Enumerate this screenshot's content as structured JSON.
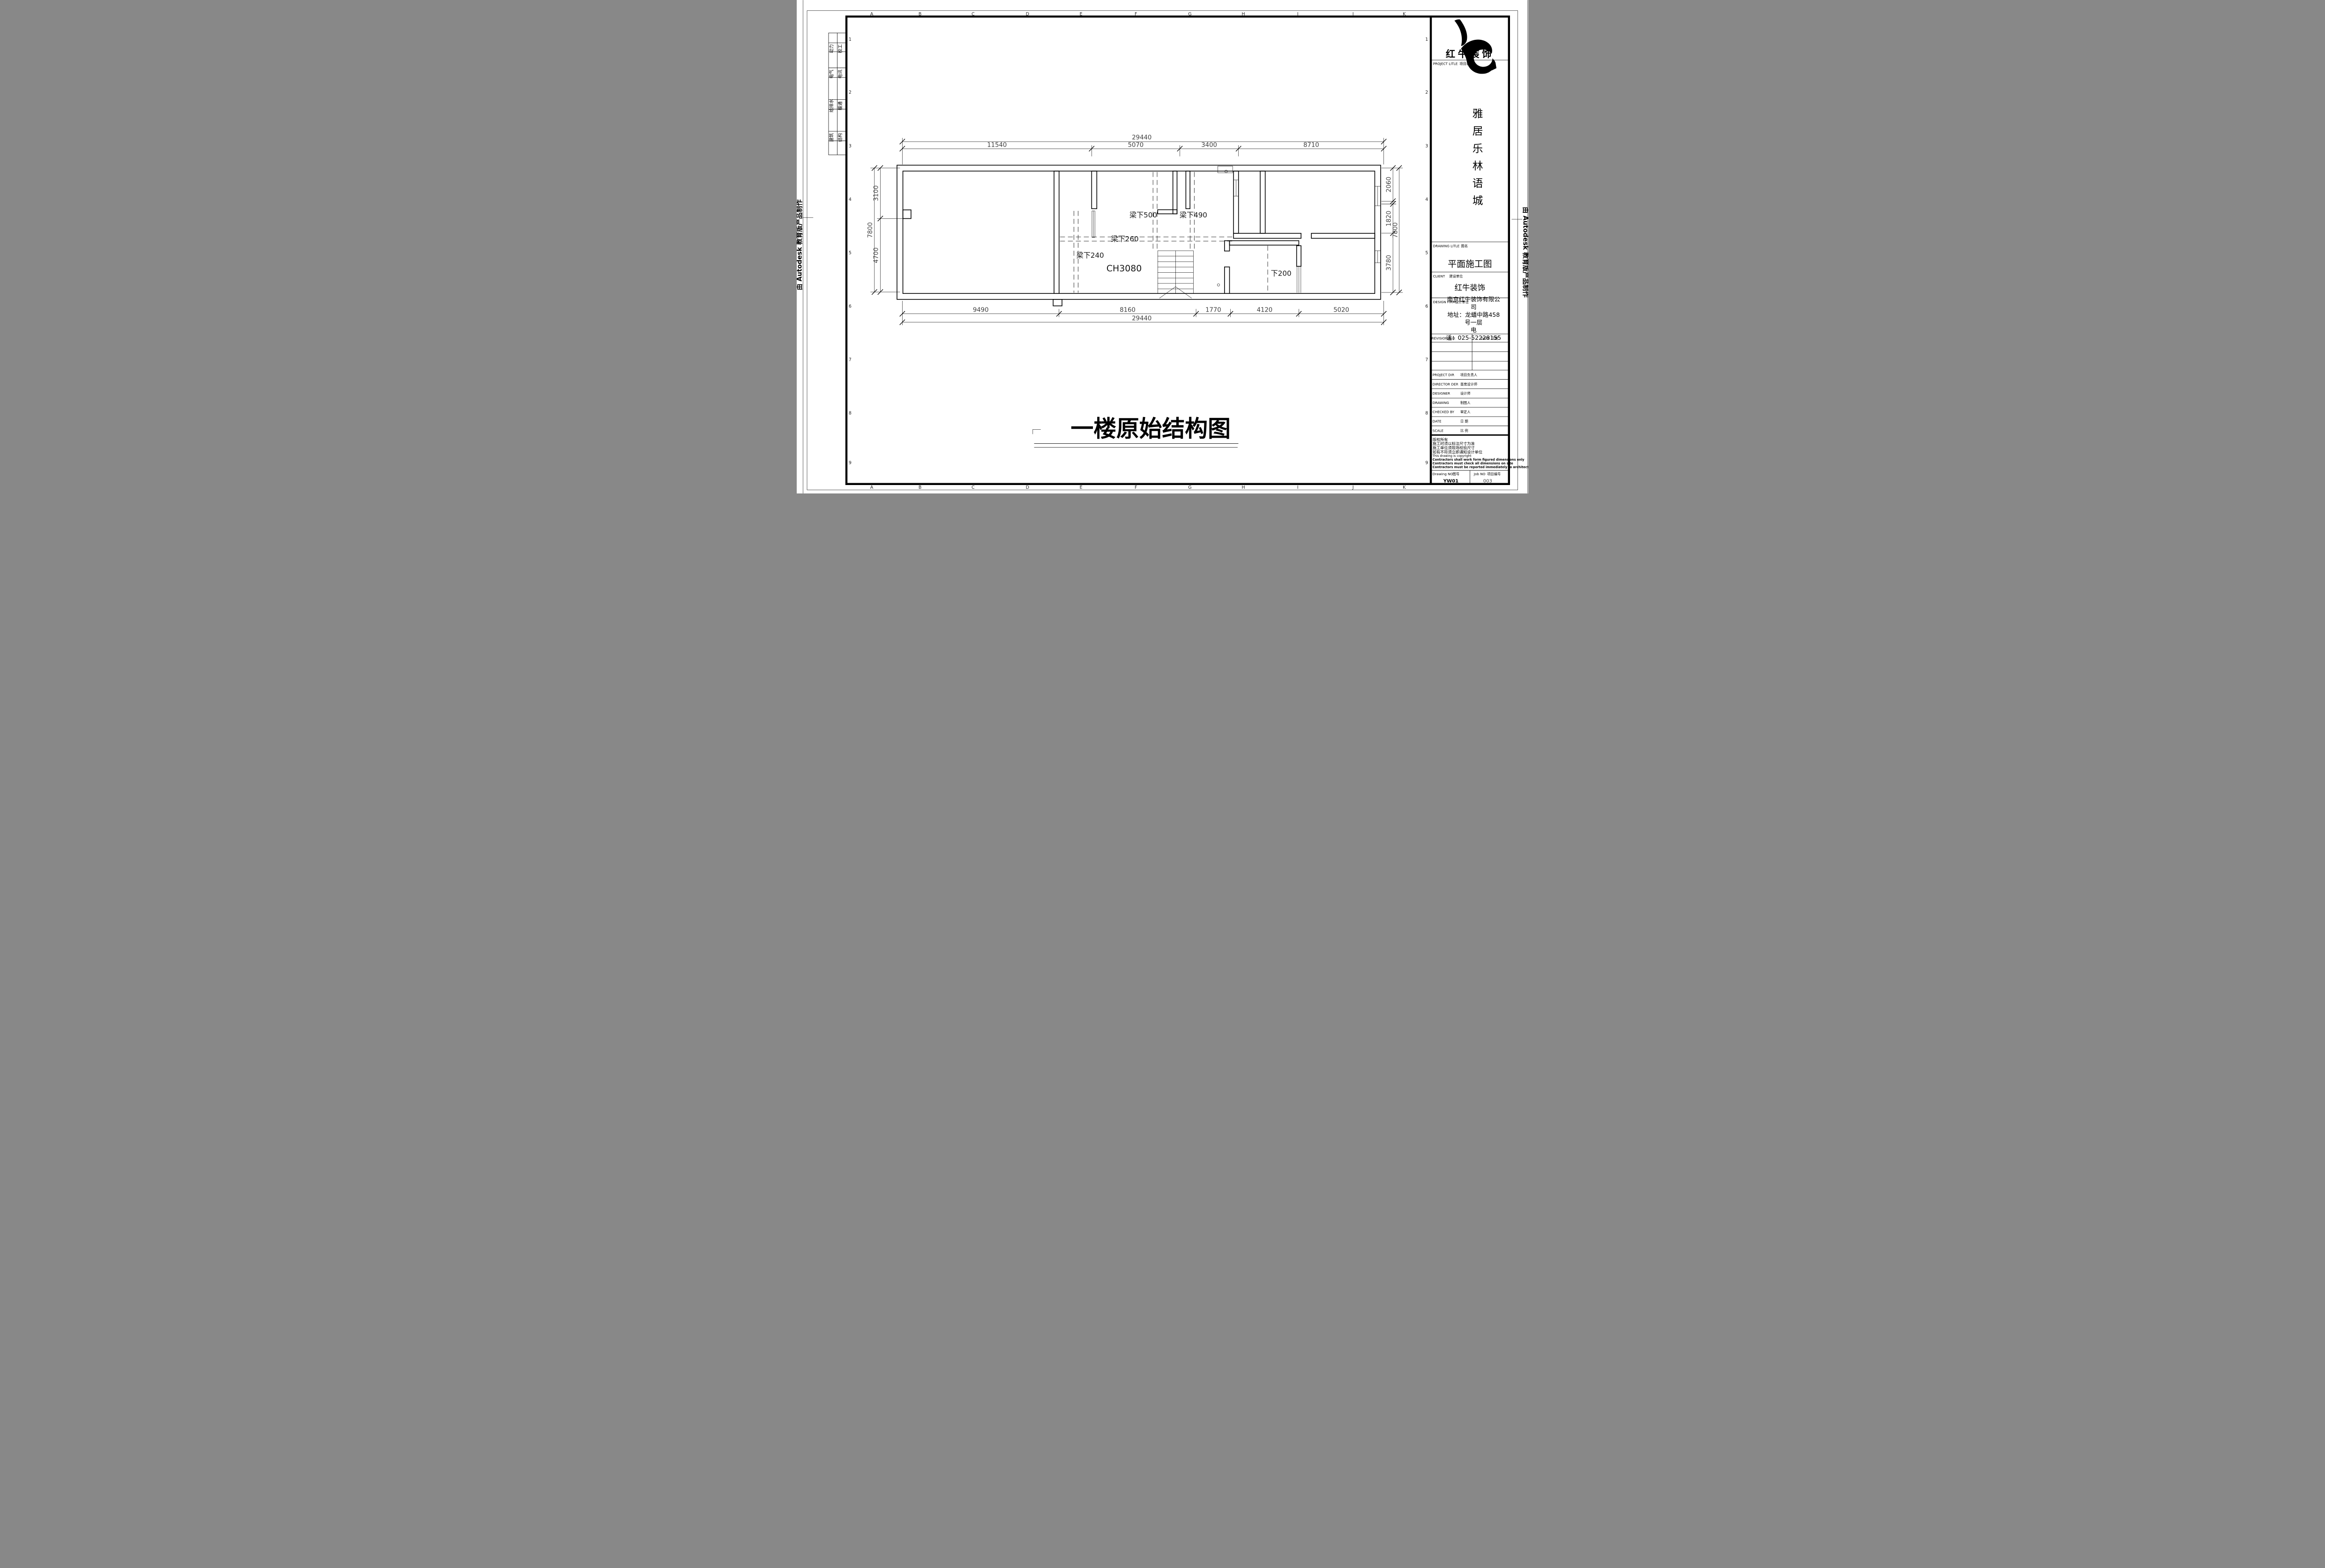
{
  "edges": {
    "autodesk_left": "由 Autodesk 教育版产品制作",
    "autodesk_right": "由 Autodesk 教育版产品制作"
  },
  "grid": {
    "letters": [
      "A",
      "B",
      "C",
      "D",
      "E",
      "F",
      "G",
      "H",
      "I",
      "J",
      "K"
    ],
    "numbers": [
      "1",
      "2",
      "3",
      "4",
      "5",
      "6",
      "7",
      "8",
      "9"
    ]
  },
  "disciplines": {
    "col1": [
      "动力",
      "电气",
      "给排水",
      "建筑"
    ],
    "col2": [
      "校工",
      "电讯",
      "暖通",
      "结构"
    ]
  },
  "plan": {
    "labels": {
      "beam500": "梁下500",
      "beam490": "梁下490",
      "beam260": "梁下260",
      "beam240": "梁下240",
      "ceiling_height": "CH3080",
      "down200": "下200"
    },
    "dims": {
      "top_overall": "29440",
      "top_chain": [
        "11540",
        "5070",
        "3400",
        "8710"
      ],
      "bottom_chain": [
        "9490",
        "8160",
        "1770",
        "4120",
        "5020"
      ],
      "bottom_overall": "29440",
      "left_outer": "7800",
      "left_chain": [
        "3100",
        "4700"
      ],
      "right_chain": [
        "2060",
        "1820",
        "3780"
      ],
      "right_outer": "7800"
    }
  },
  "title": {
    "text": "一楼原始结构图"
  },
  "title_block": {
    "logo_text": "红牛装饰",
    "project_label_en": "PROJECT LITLE",
    "project_label_cn": "项目名称",
    "project_name_chars": [
      "雅",
      "居",
      "乐",
      "林",
      "语",
      "城"
    ],
    "drawing_label_en": "DRAWING LITLE",
    "drawing_label_cn": "图名",
    "drawing_title": "平面施工图",
    "client_label_en": "CLIENT",
    "client_label_cn": "建设单位",
    "client_name": "红牛装饰",
    "firm_label_en": "DESIGN FIRM",
    "firm_label_cn": "设计单位",
    "firm_lines": [
      "南京红牛装饰有限公",
      "司",
      "地址：龙蟠中路458",
      "号一层",
      "电",
      "话：025-52228155"
    ],
    "revisions_label_en": "REVISIONS",
    "revisions_label_cn": "版本",
    "revisions_date_en": "DATE",
    "revisions_date_cn": "日期",
    "personnel": [
      {
        "en": "PROJECT DIR",
        "cn": "项目负责人"
      },
      {
        "en": "DIRECTOR DER",
        "cn": "首席设计师"
      },
      {
        "en": "DESIGNER",
        "cn": "设计师"
      },
      {
        "en": "DRAWING",
        "cn": "制图人"
      },
      {
        "en": "CHECKED BY",
        "cn": "审定人"
      },
      {
        "en": "DATE",
        "cn": "日  期"
      },
      {
        "en": "SCALE",
        "cn": "比  例"
      }
    ],
    "copyright_lines": [
      "版权所有",
      "施工时须以标注尺寸为准",
      "施工单位须现场校验尺寸",
      "如有不符须立即通知设计单位",
      "This drawing is copyright",
      "Contractors shall work form figured dimensions only",
      "Contractors must check all dimensions on site",
      "Contractors must be reported immediately to architects"
    ],
    "drawing_no_label_en": "Drawing NO",
    "drawing_no_label_cn": "图号",
    "drawing_no_value": "YW01",
    "job_no_label_en": "Job NO",
    "job_no_label_cn": "项目编号",
    "job_no_value": "003"
  }
}
